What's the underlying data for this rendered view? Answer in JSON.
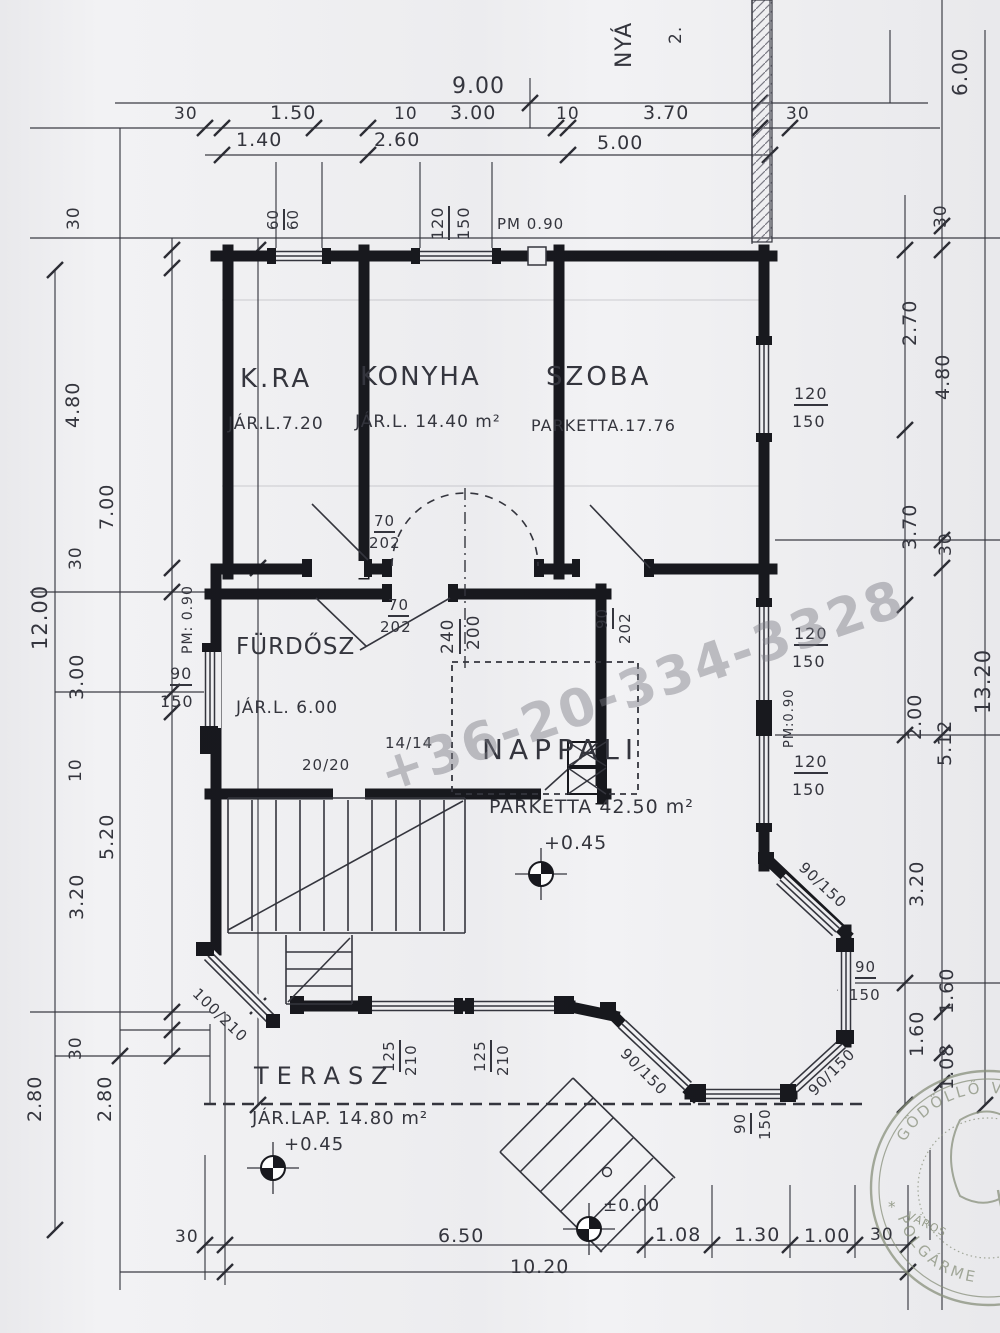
{
  "colors": {
    "paper": "#f2f2f4",
    "ink": "#34353d",
    "wall": "#17181d",
    "pencil": "#7a7a84",
    "tick": "#2c2d34",
    "watermark": "rgba(125,125,133,0.45)",
    "stamp": "#8c947e"
  },
  "watermark": {
    "text": "+36-20-334-3328"
  },
  "stamp": {
    "arc_top": "GÖDÖLLŐ V",
    "arc_bottom": "POLGÁRME",
    "inner_text": "VÁROS",
    "star": "*"
  },
  "rooms": [
    {
      "label": "K.RA",
      "info": "JÁR.L.7.20"
    },
    {
      "label": "KONYHA",
      "info": "JÁR.L. 14.40 m²"
    },
    {
      "label": "SZOBA",
      "info": "PARKETTA.17.76"
    },
    {
      "label": "FÜRDŐSZ",
      "info": "JÁR.L. 6.00"
    },
    {
      "label": "NAPPALI",
      "info": "PARKETTA 42.50 m²",
      "level": "+0.45"
    },
    {
      "label": "TERASZ",
      "info": "JÁR.LAP. 14.80 m²",
      "level": "+0.45"
    }
  ],
  "levels": {
    "nappali": "+0.45",
    "terasz": "+0.45",
    "entry": "±0.00"
  },
  "labels": [
    {
      "n": "dim-total-9-00",
      "t": "9.00",
      "x": 452,
      "y": 76,
      "r": 0,
      "s": 22
    },
    {
      "n": "dim-30-tl",
      "t": "30",
      "x": 174,
      "y": 106,
      "r": 0,
      "s": 17
    },
    {
      "n": "dim-1-50",
      "t": "1.50",
      "x": 270,
      "y": 104,
      "r": 0,
      "s": 19
    },
    {
      "n": "dim-10-a",
      "t": "10",
      "x": 394,
      "y": 106,
      "r": 0,
      "s": 17
    },
    {
      "n": "dim-3-00-t",
      "t": "3.00",
      "x": 450,
      "y": 104,
      "r": 0,
      "s": 19
    },
    {
      "n": "dim-10-b",
      "t": "10",
      "x": 556,
      "y": 106,
      "r": 0,
      "s": 17
    },
    {
      "n": "dim-3-70-t",
      "t": "3.70",
      "x": 643,
      "y": 104,
      "r": 0,
      "s": 19
    },
    {
      "n": "dim-30-tr",
      "t": "30",
      "x": 786,
      "y": 106,
      "r": 0,
      "s": 17
    },
    {
      "n": "dim-1-40",
      "t": "1.40",
      "x": 236,
      "y": 131,
      "r": 0,
      "s": 19
    },
    {
      "n": "dim-2-60",
      "t": "2.60",
      "x": 374,
      "y": 131,
      "r": 0,
      "s": 19
    },
    {
      "n": "dim-5-00",
      "t": "5.00",
      "x": 597,
      "y": 134,
      "r": 0,
      "s": 19
    },
    {
      "n": "pm-090-top",
      "t": "PM 0.90",
      "x": 497,
      "y": 217,
      "r": 0,
      "s": 15
    },
    {
      "n": "win-60-num",
      "t": "60",
      "x": 266,
      "y": 230,
      "r": -90,
      "s": 15,
      "u": true
    },
    {
      "n": "win-60-den",
      "t": "60",
      "x": 286,
      "y": 230,
      "r": -90,
      "s": 15
    },
    {
      "n": "win-120-t-num",
      "t": "120",
      "x": 430,
      "y": 240,
      "r": -90,
      "s": 16,
      "u": true
    },
    {
      "n": "win-150-t-den",
      "t": "150",
      "x": 456,
      "y": 240,
      "r": -90,
      "s": 16
    },
    {
      "n": "side-note-nya",
      "t": "NYÁ",
      "x": 614,
      "y": 68,
      "r": -90,
      "s": 22
    },
    {
      "n": "side-note-2",
      "t": "2.",
      "x": 668,
      "y": 44,
      "r": -90,
      "s": 17
    },
    {
      "n": "dim-6-00-r",
      "t": "6.00",
      "x": 950,
      "y": 96,
      "r": -90,
      "s": 20
    },
    {
      "n": "dim-30-l1",
      "t": "30",
      "x": 66,
      "y": 230,
      "r": -90,
      "s": 17
    },
    {
      "n": "dim-4-80-l",
      "t": "4.80",
      "x": 64,
      "y": 428,
      "r": -90,
      "s": 19
    },
    {
      "n": "dim-7-00-l",
      "t": "7.00",
      "x": 98,
      "y": 530,
      "r": -90,
      "s": 19
    },
    {
      "n": "dim-30-l2",
      "t": "30",
      "x": 68,
      "y": 570,
      "r": -90,
      "s": 17
    },
    {
      "n": "dim-12-00",
      "t": "12.00",
      "x": 30,
      "y": 650,
      "r": -90,
      "s": 21
    },
    {
      "n": "dim-3-00-l",
      "t": "3.00",
      "x": 68,
      "y": 700,
      "r": -90,
      "s": 19
    },
    {
      "n": "dim-10-l",
      "t": "10",
      "x": 68,
      "y": 782,
      "r": -90,
      "s": 17
    },
    {
      "n": "dim-5-20-l",
      "t": "5.20",
      "x": 98,
      "y": 860,
      "r": -90,
      "s": 19
    },
    {
      "n": "dim-3-20-l",
      "t": "3.20",
      "x": 68,
      "y": 920,
      "r": -90,
      "s": 19
    },
    {
      "n": "dim-30-l3",
      "t": "30",
      "x": 68,
      "y": 1060,
      "r": -90,
      "s": 17
    },
    {
      "n": "dim-2-80-la",
      "t": "2.80",
      "x": 26,
      "y": 1122,
      "r": -90,
      "s": 19
    },
    {
      "n": "dim-2-80-lb",
      "t": "2.80",
      "x": 96,
      "y": 1122,
      "r": -90,
      "s": 19
    },
    {
      "n": "dim-30-r1",
      "t": "30",
      "x": 933,
      "y": 228,
      "r": -90,
      "s": 17
    },
    {
      "n": "dim-2-70-r",
      "t": "2.70",
      "x": 901,
      "y": 346,
      "r": -90,
      "s": 19
    },
    {
      "n": "dim-4-80-r",
      "t": "4.80",
      "x": 934,
      "y": 400,
      "r": -90,
      "s": 19
    },
    {
      "n": "dim-3-70-r",
      "t": "3.70",
      "x": 901,
      "y": 550,
      "r": -90,
      "s": 19
    },
    {
      "n": "dim-30-r2",
      "t": "30",
      "x": 938,
      "y": 556,
      "r": -90,
      "s": 17
    },
    {
      "n": "dim-13-20",
      "t": "13.20",
      "x": 973,
      "y": 714,
      "r": -90,
      "s": 21
    },
    {
      "n": "dim-2-00-r",
      "t": "2.00",
      "x": 906,
      "y": 740,
      "r": -90,
      "s": 19
    },
    {
      "n": "dim-5-12-r",
      "t": "5.12",
      "x": 936,
      "y": 766,
      "r": -90,
      "s": 19
    },
    {
      "n": "dim-3-20-r",
      "t": "3.20",
      "x": 908,
      "y": 907,
      "r": -90,
      "s": 19
    },
    {
      "n": "dim-1-60-ra",
      "t": "1.60",
      "x": 938,
      "y": 1014,
      "r": -90,
      "s": 19
    },
    {
      "n": "dim-1-60-rb",
      "t": "1.60",
      "x": 908,
      "y": 1057,
      "r": -90,
      "s": 19
    },
    {
      "n": "dim-1-08-r",
      "t": "1.08",
      "x": 938,
      "y": 1090,
      "r": -90,
      "s": 19
    },
    {
      "n": "dim-30-ba",
      "t": "30",
      "x": 175,
      "y": 1229,
      "r": 0,
      "s": 17
    },
    {
      "n": "dim-6-50",
      "t": "6.50",
      "x": 438,
      "y": 1227,
      "r": 0,
      "s": 19
    },
    {
      "n": "dim-10-20",
      "t": "10.20",
      "x": 510,
      "y": 1258,
      "r": 0,
      "s": 19
    },
    {
      "n": "dim-1-08-b",
      "t": "1.08",
      "x": 655,
      "y": 1226,
      "r": 0,
      "s": 19
    },
    {
      "n": "dim-1-30-b",
      "t": "1.30",
      "x": 734,
      "y": 1226,
      "r": 0,
      "s": 19
    },
    {
      "n": "dim-1-00-b",
      "t": "1.00",
      "x": 804,
      "y": 1227,
      "r": 0,
      "s": 19
    },
    {
      "n": "dim-30-bb",
      "t": "30",
      "x": 870,
      "y": 1227,
      "r": 0,
      "s": 17
    },
    {
      "n": "room-kra",
      "t": "K.RA",
      "x": 240,
      "y": 366,
      "r": 0,
      "s": 26,
      "ls": 3
    },
    {
      "n": "room-kra-info",
      "t": "JÁR.L.7.20",
      "x": 228,
      "y": 416,
      "r": 0,
      "s": 17
    },
    {
      "n": "room-konyha",
      "t": "KONYHA",
      "x": 360,
      "y": 364,
      "r": 0,
      "s": 26,
      "ls": 2
    },
    {
      "n": "room-konyha-info",
      "t": "JÁR.L. 14.40 m²",
      "x": 355,
      "y": 414,
      "r": 0,
      "s": 17
    },
    {
      "n": "room-szoba",
      "t": "SZOBA",
      "x": 546,
      "y": 364,
      "r": 0,
      "s": 26,
      "ls": 3
    },
    {
      "n": "room-szoba-info",
      "t": "PARKETTA.17.76",
      "x": 531,
      "y": 418,
      "r": 0,
      "s": 16
    },
    {
      "n": "room-furdosz",
      "t": "FÜRDŐSZ",
      "x": 236,
      "y": 636,
      "r": 0,
      "s": 23,
      "ls": 1
    },
    {
      "n": "room-furdosz-info",
      "t": "JÁR.L. 6.00",
      "x": 236,
      "y": 700,
      "r": 0,
      "s": 17
    },
    {
      "n": "room-nappali",
      "t": "NAPPALI",
      "x": 482,
      "y": 736,
      "r": 0,
      "s": 28,
      "ls": 6
    },
    {
      "n": "room-nappali-info",
      "t": "PARKETTA 42.50 m²",
      "x": 489,
      "y": 798,
      "r": 0,
      "s": 19
    },
    {
      "n": "level-nappali",
      "t": "+0.45",
      "x": 544,
      "y": 834,
      "r": 0,
      "s": 19
    },
    {
      "n": "room-terasz",
      "t": "TERASZ",
      "x": 254,
      "y": 1064,
      "r": 0,
      "s": 24,
      "ls": 8
    },
    {
      "n": "room-terasz-info",
      "t": "JÁR.LAP. 14.80 m²",
      "x": 252,
      "y": 1110,
      "r": 0,
      "s": 18
    },
    {
      "n": "level-terasz",
      "t": "+0.45",
      "x": 284,
      "y": 1136,
      "r": 0,
      "s": 18
    },
    {
      "n": "level-ground",
      "t": "±0.00",
      "x": 603,
      "y": 1198,
      "r": 0,
      "s": 17
    },
    {
      "n": "door-70-202-a-num",
      "t": "70",
      "x": 374,
      "y": 514,
      "r": 0,
      "s": 15,
      "u": true
    },
    {
      "n": "door-70-202-a-den",
      "t": "202",
      "x": 369,
      "y": 536,
      "r": 0,
      "s": 15
    },
    {
      "n": "door-70-202-b-num",
      "t": "70",
      "x": 388,
      "y": 598,
      "r": 0,
      "s": 15,
      "u": true
    },
    {
      "n": "door-70-202-b-den",
      "t": "202",
      "x": 380,
      "y": 620,
      "r": 0,
      "s": 15
    },
    {
      "n": "open-240-num",
      "t": "240",
      "x": 440,
      "y": 654,
      "r": -90,
      "s": 17,
      "u": true
    },
    {
      "n": "open-200-den",
      "t": "200",
      "x": 466,
      "y": 650,
      "r": -90,
      "s": 17
    },
    {
      "n": "door-90-202-num",
      "t": "90",
      "x": 595,
      "y": 629,
      "r": -90,
      "s": 15,
      "u": true
    },
    {
      "n": "door-90-202-den",
      "t": "202",
      "x": 618,
      "y": 644,
      "r": -90,
      "s": 15
    },
    {
      "n": "note-14-14",
      "t": "14/14",
      "x": 385,
      "y": 736,
      "r": 0,
      "s": 15
    },
    {
      "n": "note-20-20",
      "t": "20/20",
      "x": 302,
      "y": 758,
      "r": 0,
      "s": 15
    },
    {
      "n": "win-90-left-num",
      "t": "90",
      "x": 170,
      "y": 666,
      "r": 0,
      "s": 16,
      "u": true
    },
    {
      "n": "win-150-left-den",
      "t": "150",
      "x": 160,
      "y": 694,
      "r": 0,
      "s": 16
    },
    {
      "n": "pm-090-left",
      "t": "PM: 0.90",
      "x": 181,
      "y": 654,
      "r": -90,
      "s": 14
    },
    {
      "n": "win-120-szoba-num",
      "t": "120",
      "x": 794,
      "y": 386,
      "r": 0,
      "s": 16,
      "u": true
    },
    {
      "n": "win-150-szoba-den",
      "t": "150",
      "x": 792,
      "y": 414,
      "r": 0,
      "s": 16
    },
    {
      "n": "win-120-r1-num",
      "t": "120",
      "x": 794,
      "y": 626,
      "r": 0,
      "s": 16,
      "u": true
    },
    {
      "n": "win-150-r1-den",
      "t": "150",
      "x": 792,
      "y": 654,
      "r": 0,
      "s": 16
    },
    {
      "n": "pm-090-right",
      "t": "PM:0.90",
      "x": 783,
      "y": 748,
      "r": -90,
      "s": 13
    },
    {
      "n": "win-120-r2-num",
      "t": "120",
      "x": 794,
      "y": 754,
      "r": 0,
      "s": 16,
      "u": true
    },
    {
      "n": "win-150-r2-den",
      "t": "150",
      "x": 792,
      "y": 782,
      "r": 0,
      "s": 16
    },
    {
      "n": "bay-ne-90-150",
      "t": "90/150",
      "x": 806,
      "y": 860,
      "r": 43,
      "s": 15
    },
    {
      "n": "bay-e-90-num",
      "t": "90",
      "x": 855,
      "y": 960,
      "r": 0,
      "s": 15,
      "u": true
    },
    {
      "n": "bay-e-150-den",
      "t": "150",
      "x": 849,
      "y": 988,
      "r": 0,
      "s": 15
    },
    {
      "n": "bay-se-90-150",
      "t": "90/150",
      "x": 806,
      "y": 1088,
      "r": -45,
      "s": 15
    },
    {
      "n": "bay-sw-90-150",
      "t": "90/150",
      "x": 628,
      "y": 1046,
      "r": 45,
      "s": 15
    },
    {
      "n": "bay-s-90-num",
      "t": "90",
      "x": 733,
      "y": 1134,
      "r": -90,
      "s": 15,
      "u": true
    },
    {
      "n": "bay-s-150-den",
      "t": "150",
      "x": 758,
      "y": 1140,
      "r": -90,
      "s": 15
    },
    {
      "n": "door-100-210",
      "t": "100/210",
      "x": 200,
      "y": 986,
      "r": 44,
      "s": 15
    },
    {
      "n": "win-125-a-num",
      "t": "125",
      "x": 382,
      "y": 1072,
      "r": -90,
      "s": 15,
      "u": true
    },
    {
      "n": "win-125-a-den",
      "t": "210",
      "x": 404,
      "y": 1076,
      "r": -90,
      "s": 15
    },
    {
      "n": "win-125-b-num",
      "t": "125",
      "x": 473,
      "y": 1072,
      "r": -90,
      "s": 15,
      "u": true
    },
    {
      "n": "win-125-b-den",
      "t": "210",
      "x": 496,
      "y": 1076,
      "r": -90,
      "s": 15
    },
    {
      "n": "stamp-inner-text",
      "t": "VÁROS",
      "x": 910,
      "y": 1210,
      "r": 26,
      "s": 11,
      "c": "stamp"
    },
    {
      "n": "stamp-star",
      "t": "*",
      "x": 888,
      "y": 1200,
      "r": 0,
      "s": 15,
      "c": "stamp"
    }
  ]
}
